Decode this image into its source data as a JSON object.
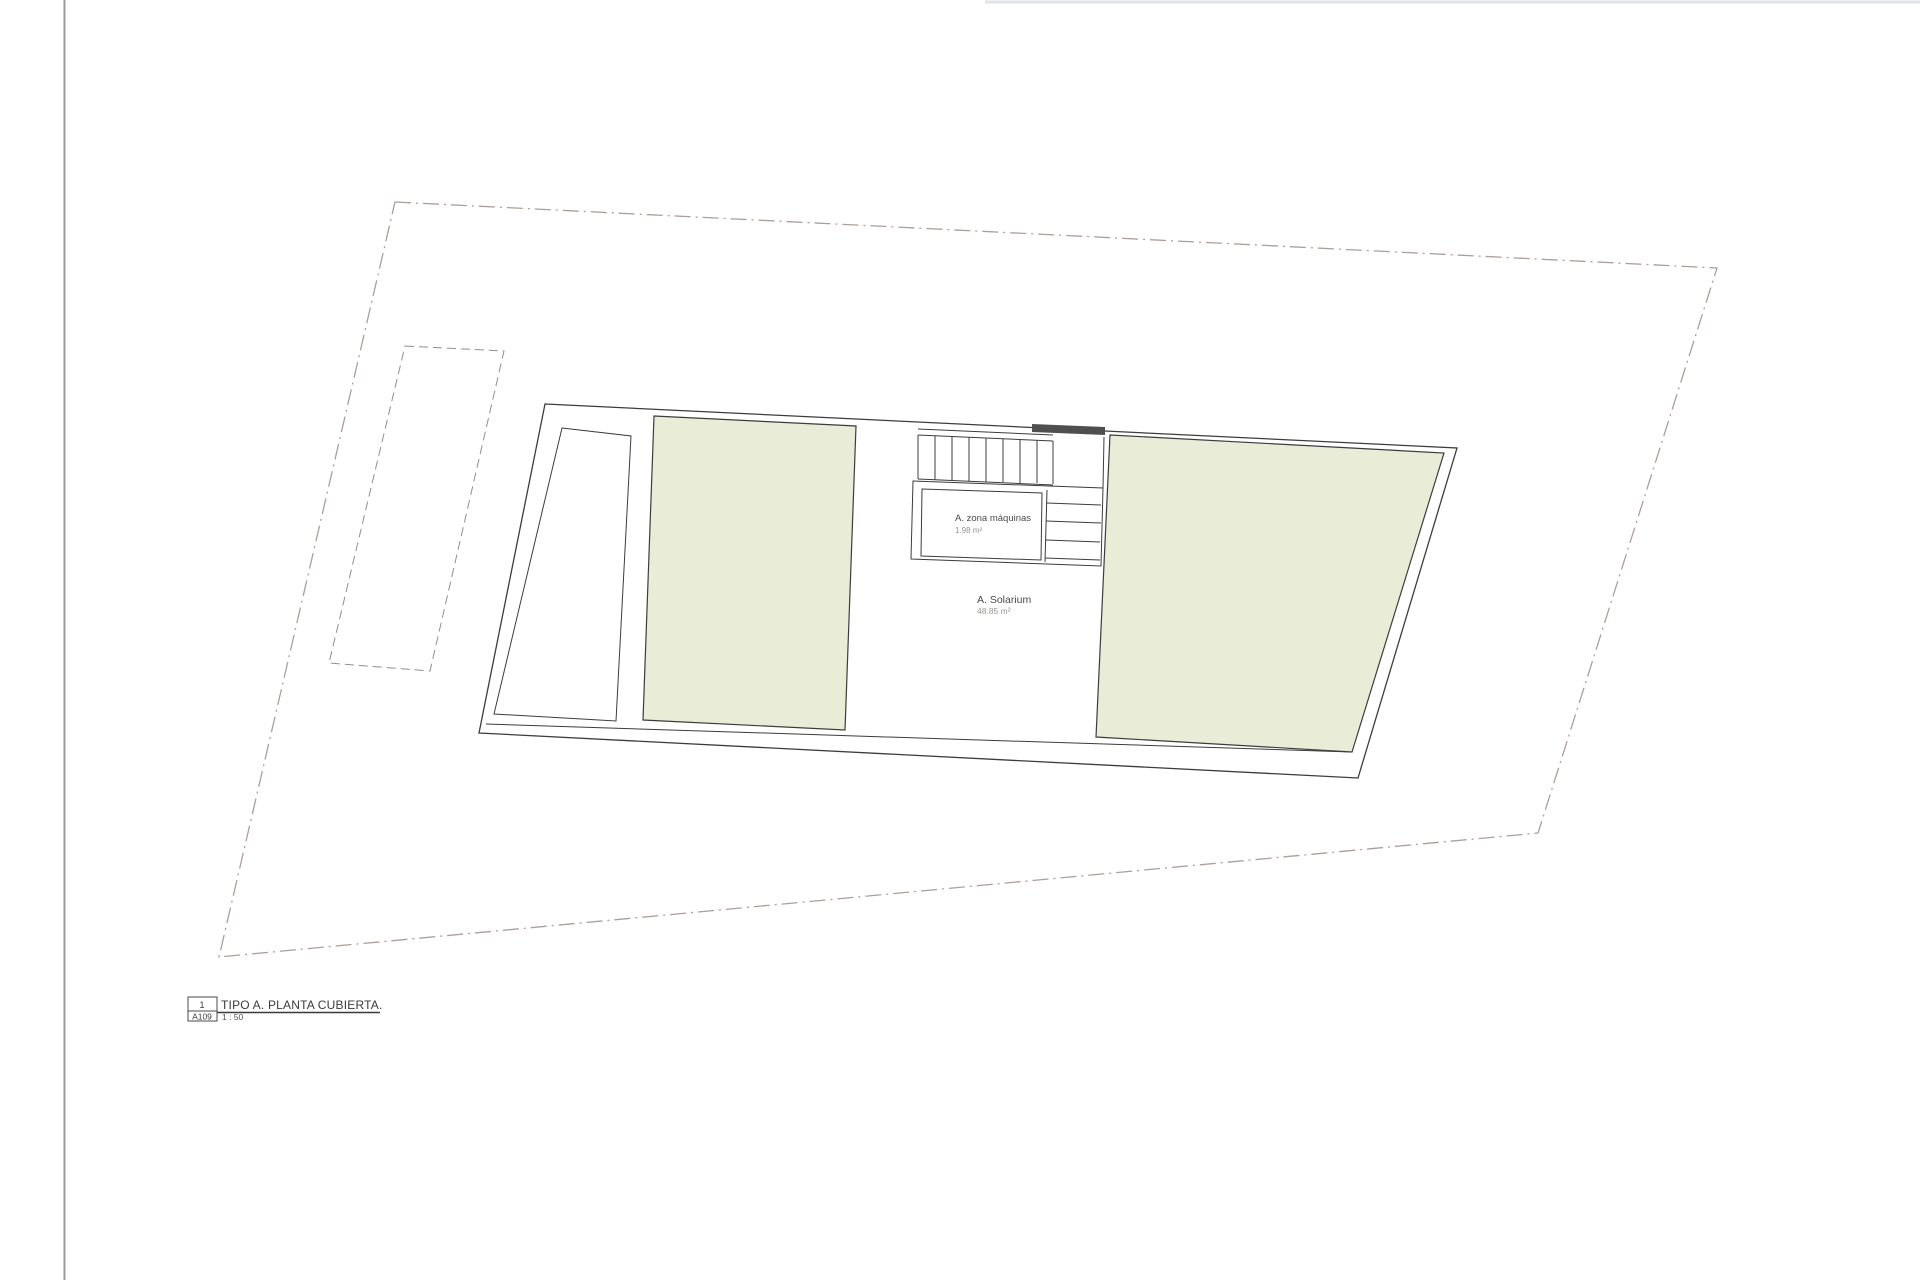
{
  "colors": {
    "terrace_fill": "#e9ecd7",
    "drawing_line": "#3c3c3c",
    "site_boundary_line": "#ab9f99",
    "setback_dash_line": "#8f8f8f",
    "stair_wall_fill": "#4f4f4f",
    "label_text": "#4a4a4a",
    "area_text": "#98938f"
  },
  "plan": {
    "machine_room": {
      "label": "A. zona máquinas",
      "area": "1.98 m²"
    },
    "solarium": {
      "label": "A. Solarium",
      "area": "48.85 m²"
    }
  },
  "title_block": {
    "drawing_number": "1",
    "sheet_code": "A109",
    "title": "TIPO A. PLANTA CUBIERTA.",
    "scale": "1 : 50"
  }
}
